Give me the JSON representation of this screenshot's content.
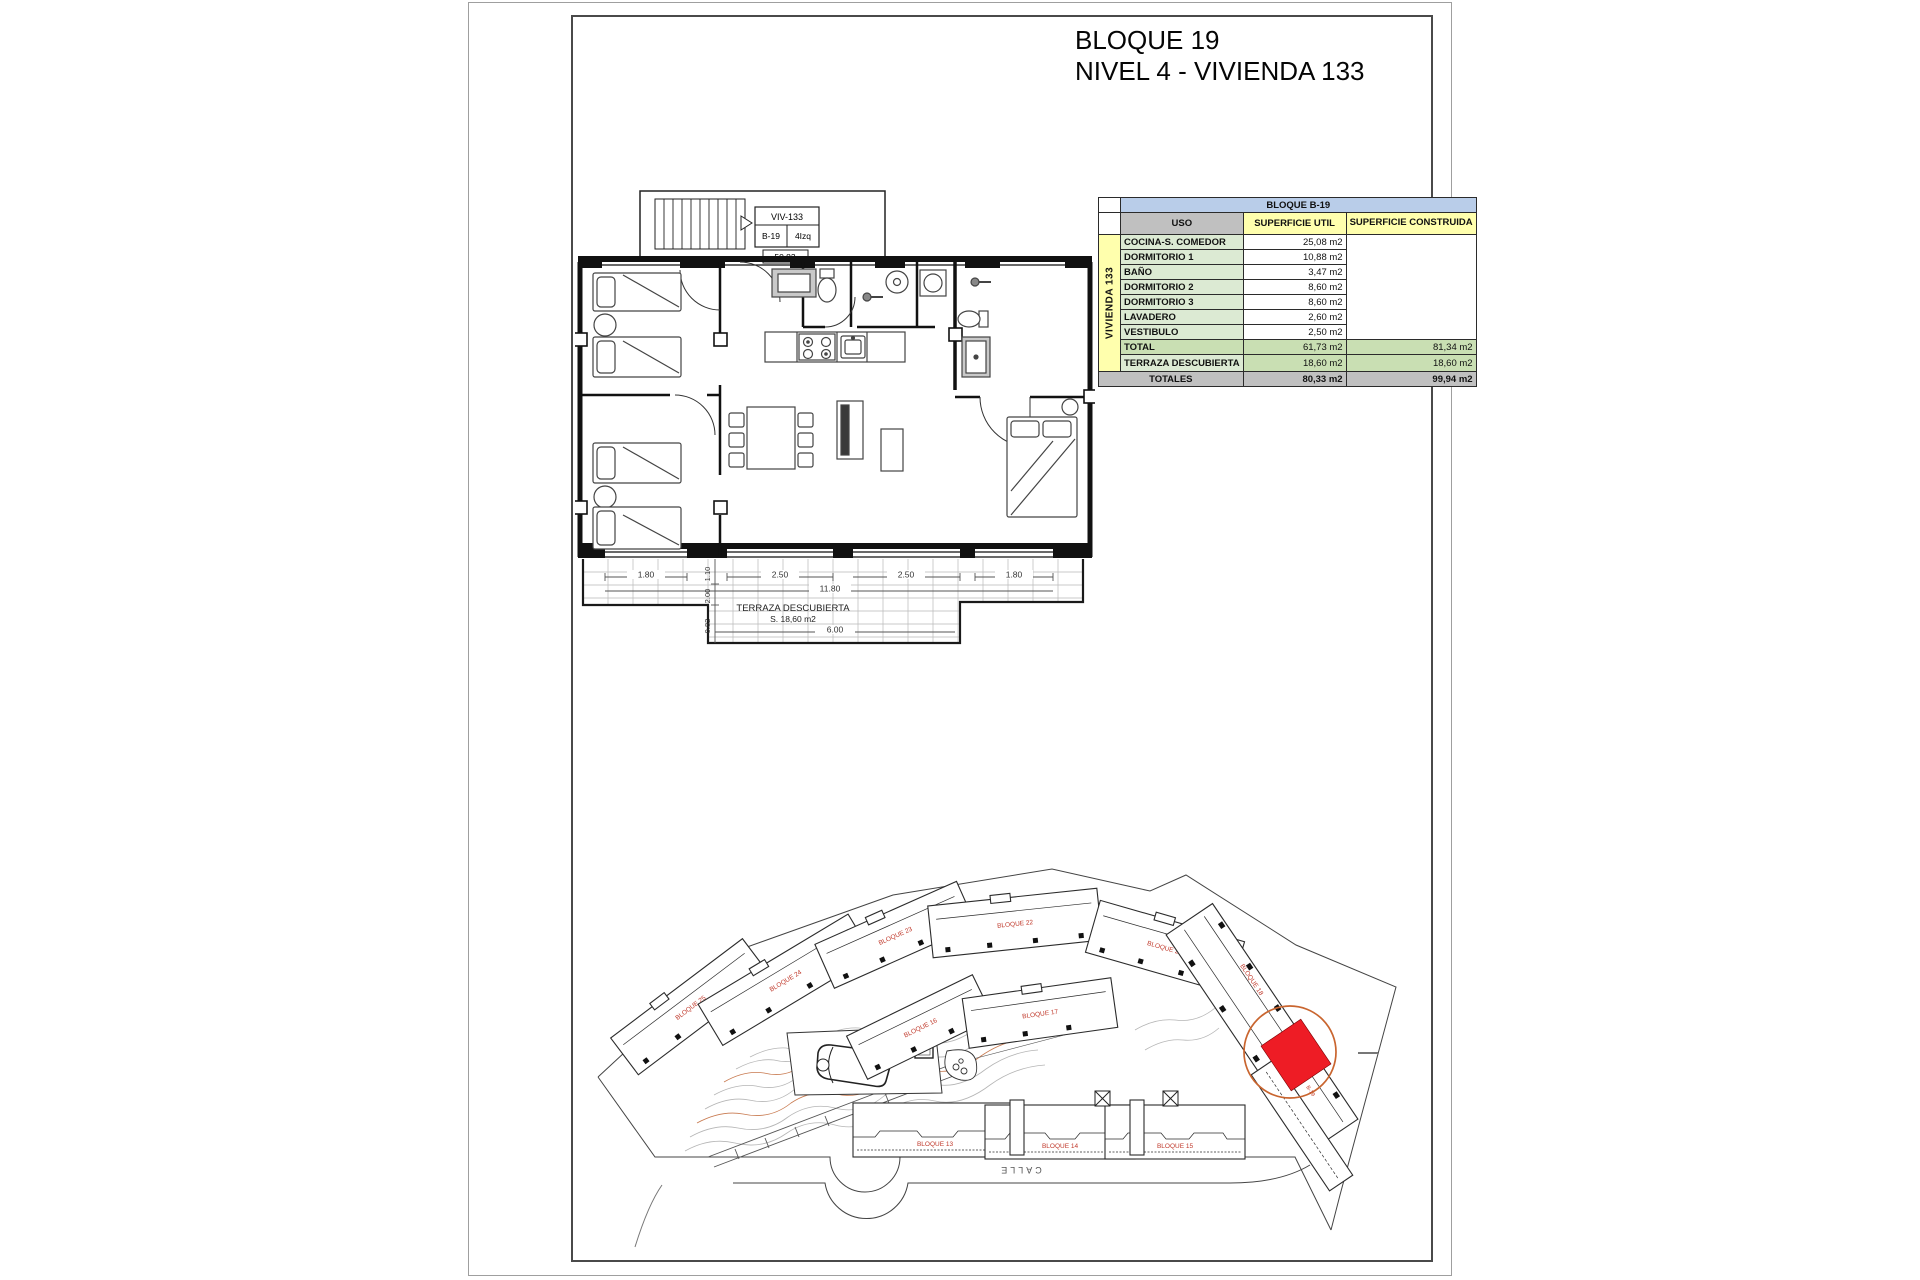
{
  "sheet": {
    "title_line1": "BLOQUE 19",
    "title_line2": "NIVEL 4 - VIVIENDA 133"
  },
  "unit_tag": {
    "viv": "VIV-133",
    "block": "B-19",
    "position": "4Izq",
    "area_code": "50.83"
  },
  "floorplan": {
    "terrace_label": "TERRAZA DESCUBIERTA",
    "terrace_area": "S. 18,60 m2",
    "dims": {
      "w1": "1.80",
      "w2": "2.50",
      "w3": "2.50",
      "w4": "1.80",
      "width_total": "11.80",
      "bottom": "6.00",
      "v1": "1.10",
      "v2": "2.00",
      "v3": "0.82"
    }
  },
  "areas_table": {
    "title": "BLOQUE B-19",
    "group_label": "VIVIENDA 133",
    "col_uso": "USO",
    "col_util": "SUPERFICIE UTIL",
    "col_construida": "SUPERFICIE CONSTRUIDA",
    "rows": [
      {
        "uso": "COCINA-S. COMEDOR",
        "util": "25,08 m2"
      },
      {
        "uso": "DORMITORIO 1",
        "util": "10,88 m2"
      },
      {
        "uso": "BAÑO",
        "util": "3,47 m2"
      },
      {
        "uso": "DORMITORIO 2",
        "util": "8,60 m2"
      },
      {
        "uso": "DORMITORIO 3",
        "util": "8,60 m2"
      },
      {
        "uso": "LAVADERO",
        "util": "2,60 m2"
      },
      {
        "uso": "VESTIBULO",
        "util": "2,50 m2"
      }
    ],
    "total_row": {
      "label": "TOTAL",
      "util": "61,73 m2",
      "construida": "81,34 m2"
    },
    "terrace_row": {
      "label": "TERRAZA DESCUBIERTA",
      "util": "18,60 m2",
      "construida": "18,60 m2"
    },
    "totals_row": {
      "label": "TOTALES",
      "util": "80,33 m2",
      "construida": "99,94 m2"
    }
  },
  "siteplan": {
    "block_labels": [
      "BLOQUE 25",
      "BLOQUE 24",
      "BLOQUE 23",
      "BLOQUE 22",
      "BLOQUE 21",
      "BLOQUE 16",
      "BLOQUE 17",
      "BLOQUE 18",
      "BLOQUE 13",
      "BLOQUE 14",
      "BLOQUE 15"
    ],
    "highlight_label": "B-19",
    "street_label": "CALLE",
    "colors": {
      "block_label": "#c0392b",
      "highlight_fill": "#ee1c25",
      "highlight_ring": "#c9652f",
      "contour": "#b5b5b5",
      "contour_accent": "#c87a50"
    }
  }
}
